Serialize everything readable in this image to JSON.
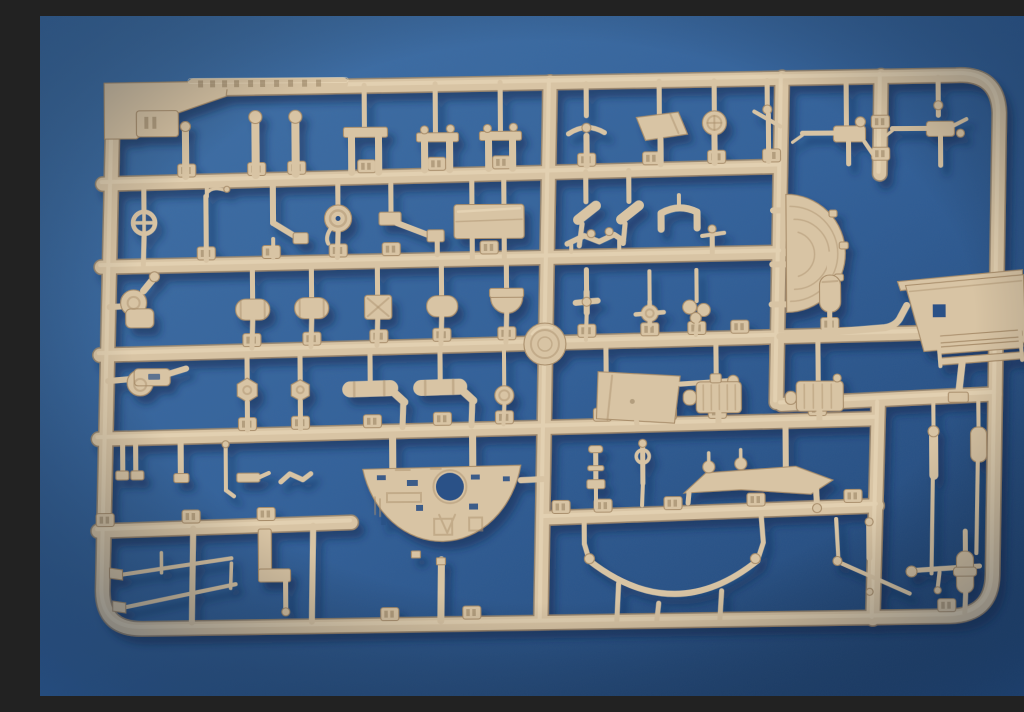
{
  "scene": {
    "description": "Photograph of a tan injection-molded plastic model kit sprue (parts tree) laid on a blue textured background; dozens of small tank-model parts with illegible embossed part-number tabs",
    "object": "model-kit-sprue",
    "background_surface": "blue fabric-textured board",
    "text_legible": false,
    "embossed_markings": "illegible raised lettering on top rail and numeric part tabs"
  },
  "colors": {
    "background_top": "#4274aa",
    "background_mid": "#32619a",
    "background_edge": "#1d4170",
    "sprue_base": "#d8c4a4",
    "sprue_edge": "#a88d6a",
    "sprue_highlight": "#f0e0c2",
    "tab_mark": "#7d6647",
    "hole_blue": "#2a5187",
    "cast_shadow": "#0f2b50"
  },
  "inventory": {
    "part_tab_count": "about 40 numbered tabs",
    "notable_parts": [
      "half-moon fan shroud",
      "semicircular turret floor plate with round hatch hole",
      "curved fender strip",
      "angled mounting plate with ladder slats",
      "two machine guns",
      "spoked wheel",
      "hand wheel",
      "pulley wheel",
      "stowage drums",
      "ribbed gearboxes",
      "tow rods",
      "gun travel lock",
      "manufacturer medallion disc"
    ]
  }
}
